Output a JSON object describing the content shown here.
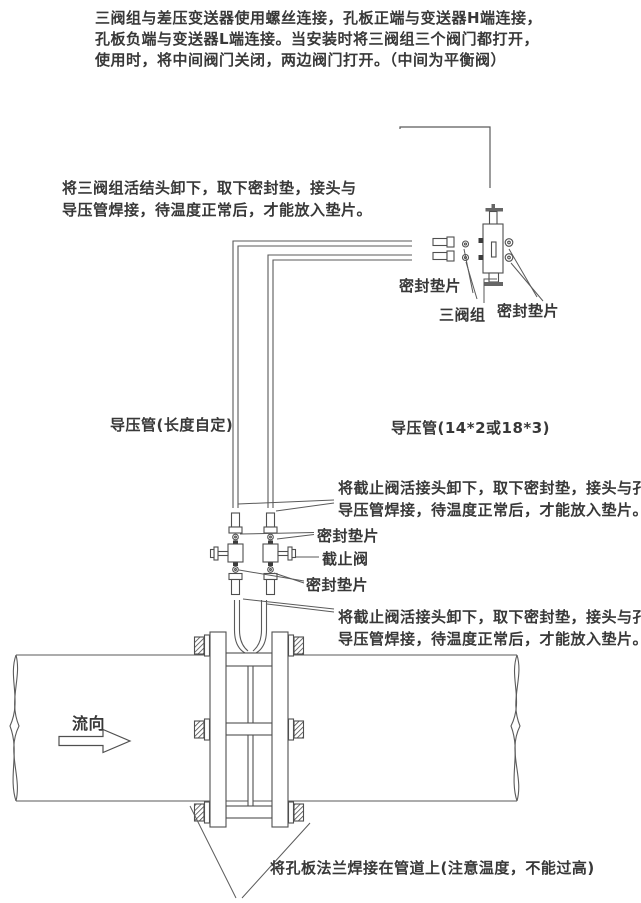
{
  "colors": {
    "background": "#ffffff",
    "ink": "#383838",
    "line": "#555555"
  },
  "notes": {
    "top_lines": [
      "三阀组与差压变送器使用螺丝连接，孔板正端与变送器H端连接，",
      "孔板负端与变送器L端连接。当安装时将三阀组三个阀门都打开，",
      "使用时，将中间阀门关闭，两边阀门打开。（中间为平衡阀）"
    ],
    "manifold_union_lines": [
      "将三阀组活结头卸下，取下密封垫，接头与",
      "导压管焊接，待温度正常后，才能放入垫片。"
    ],
    "stop_valve_upper_lines": [
      "将截止阀活接头卸下，取下密封垫，接头与孔板",
      "导压管焊接，待温度正常后，才能放入垫片。"
    ],
    "stop_valve_lower_lines": [
      "将截止阀活接头卸下，取下密封垫，接头与孔板",
      "导压管焊接，待温度正常后，才能放入垫片。"
    ],
    "flange_weld": "将孔板法兰焊接在管道上(注意温度，不能过高)"
  },
  "labels": {
    "seal_gasket_manifold_left": "密封垫片",
    "manifold": "三阀组",
    "seal_gasket_manifold_right": "密封垫片",
    "impulse_pipe_custom": "导压管(长度自定)",
    "impulse_pipe_size": "导压管(14*2或18*3)",
    "seal_gasket_valve_upper": "密封垫片",
    "stop_valve": "截止阀",
    "seal_gasket_valve_lower": "密封垫片",
    "flow_direction": "流向"
  }
}
